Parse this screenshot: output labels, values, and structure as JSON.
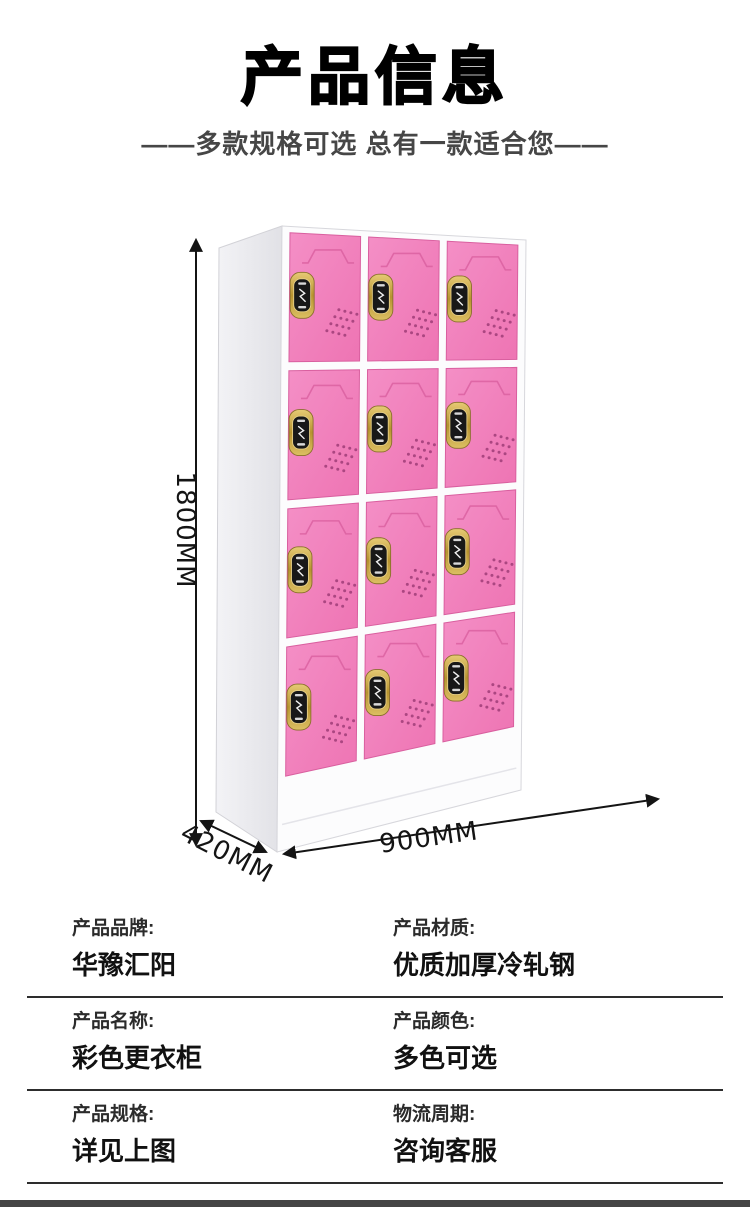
{
  "header": {
    "title": "产品信息",
    "subtitle": "——多款规格可选 总有一款适合您——"
  },
  "dimensions": {
    "height": "1800MM",
    "depth": "420MM",
    "width": "900MM"
  },
  "locker": {
    "rows": 4,
    "cols": 3,
    "door_count": 12
  },
  "colors": {
    "door_pink": "#f183c0",
    "door_edge": "#d95f9f",
    "vent_dot": "#a3407b",
    "cabinet_white": "#fcfcfd",
    "side_panel": "#ececf0",
    "lock_gold": "#c8a54b",
    "lock_face": "#181818",
    "dimension_line": "#141414",
    "divider": "#2d2d2d",
    "bottom_bar": "#454545"
  },
  "specs": {
    "rows": [
      {
        "cells": [
          {
            "label": "产品品牌:",
            "value": "华豫汇阳"
          },
          {
            "label": "产品材质:",
            "value": "优质加厚冷轧钢"
          }
        ]
      },
      {
        "cells": [
          {
            "label": "产品名称:",
            "value": "彩色更衣柜"
          },
          {
            "label": "产品颜色:",
            "value": "多色可选"
          }
        ]
      },
      {
        "cells": [
          {
            "label": "产品规格:",
            "value": "详见上图"
          },
          {
            "label": "物流周期:",
            "value": "咨询客服"
          }
        ]
      }
    ]
  }
}
